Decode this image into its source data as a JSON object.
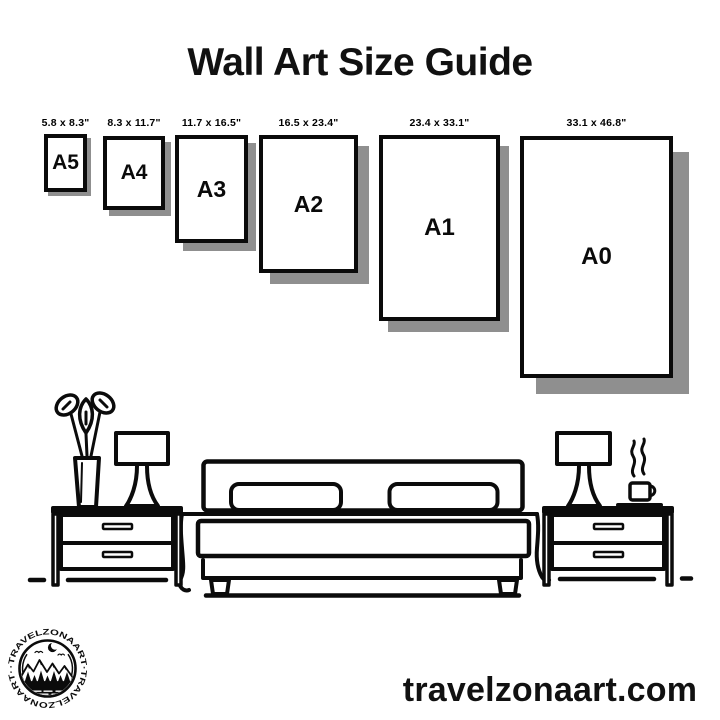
{
  "header": {
    "title": "Wall Art Size Guide"
  },
  "papers": [
    {
      "name": "A5",
      "dims": "5.8 x 8.3\""
    },
    {
      "name": "A4",
      "dims": "8.3 x 11.7\""
    },
    {
      "name": "A3",
      "dims": "11.7 x 16.5\""
    },
    {
      "name": "A2",
      "dims": "16.5 x 23.4\""
    },
    {
      "name": "A1",
      "dims": "23.4 x 33.1\""
    },
    {
      "name": "A0",
      "dims": "33.1 x 46.8\""
    }
  ],
  "logo": {
    "ring_text": "·TRAVELZONAART·TRAVELZONAART·"
  },
  "footer": {
    "website": "travelzonaart.com"
  },
  "colors": {
    "ink": "#0b0b0b",
    "paper_shadow": "#8f8f8f",
    "background": "#ffffff"
  }
}
